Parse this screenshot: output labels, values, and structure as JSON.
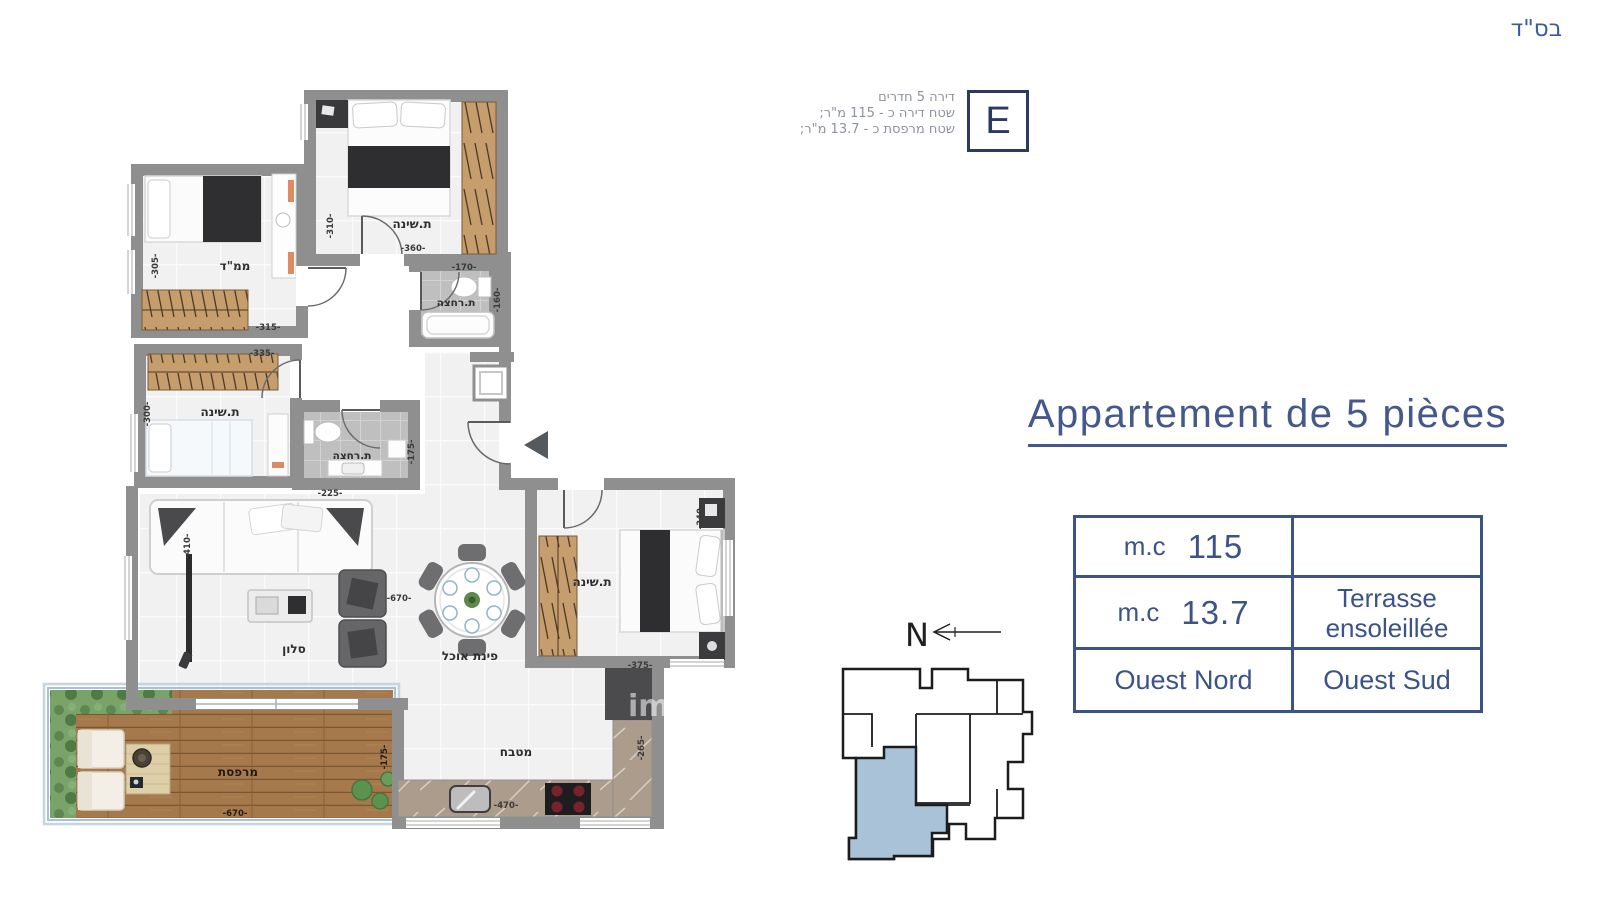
{
  "header": {
    "bsd_label": "בס\"ד"
  },
  "badge": {
    "letter": "E",
    "info_lines": [
      "דירה 5 חדרים",
      "שטח דירה כ - 115 מ\"ר;",
      "שטח מרפסת כ - 13.7 מ\"ר;"
    ]
  },
  "title": {
    "text": "Appartement de 5 pièces"
  },
  "info_table": {
    "row1": {
      "unit": "m.c",
      "value": "115",
      "note": ""
    },
    "row2": {
      "unit": "m.c",
      "value": "13.7",
      "note": "Terrasse ensoleillée"
    },
    "row3": {
      "left": "Ouest Nord",
      "right": "Ouest Sud"
    }
  },
  "site_plan": {
    "north_label": "N",
    "highlight_color": "#a9c2d8"
  },
  "floorplan": {
    "labels": {
      "bedroom_top": "ת.שינה",
      "mamad": "ממ\"ד",
      "bath1": "ת.רחצה",
      "bedroom_mid": "ת.שינה",
      "bath2": "ת.רחצה",
      "salon": "סלון",
      "dining": "פינת אוכל",
      "bedroom_right": "ת.שינה",
      "kitchen": "מטבח",
      "terrace": "מרפסת"
    },
    "dims": {
      "bedroom_top_w": "-360-",
      "bedroom_top_h": "-310-",
      "mamad_w": "-315-",
      "mamad_h": "-305-",
      "bath1_w": "-170-",
      "bath1_h": "-160-",
      "bedroom_mid_w": "-335-",
      "bedroom_mid_h": "-300-",
      "bath2_w": "-225-",
      "bath2_h": "-175-",
      "salon_w": "-670-",
      "salon_h": "-410-",
      "bedroom_right_w": "-375-",
      "bedroom_right_h": "-340-",
      "kitchen_w": "-470-",
      "kitchen_h": "-265-",
      "terrace_w": "-670-",
      "terrace_h": "-175-"
    },
    "watermark": "im"
  }
}
